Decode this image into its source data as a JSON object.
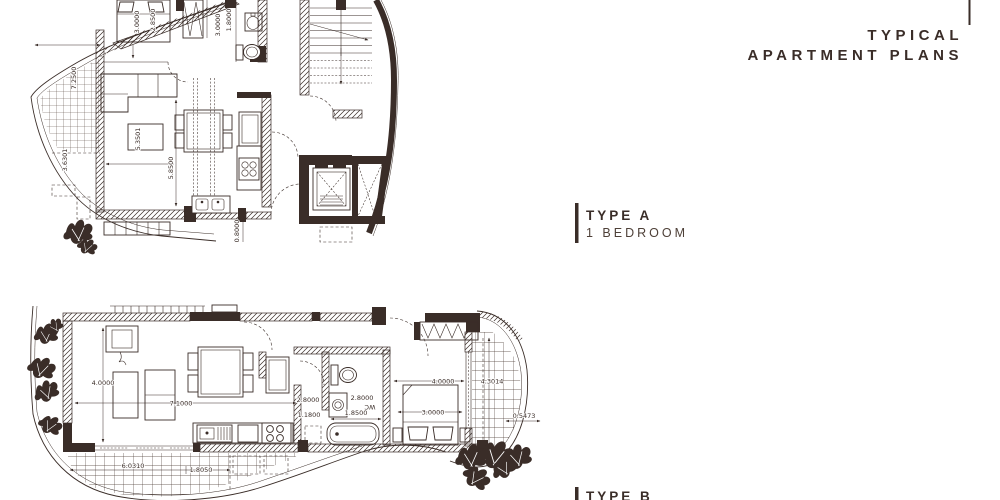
{
  "title": {
    "line1": "TYPICAL",
    "line2": "APARTMENT PLANS"
  },
  "legend_a": {
    "type": "TYPE A",
    "subtitle": "1 BEDROOM"
  },
  "legend_b": {
    "type": "TYPE B"
  },
  "colors": {
    "ink": "#3a2d28",
    "background": "#ffffff"
  },
  "plan_a": {
    "name": "Type A one-bedroom apartment floor plan",
    "dims": {
      "bed_w": "3.0000",
      "bed_l": "2.8500",
      "hall": "3.0000",
      "bath": "1.8000",
      "terrace": "7.2500",
      "terrace2": "3.6301",
      "coffee": "5.3501",
      "living": "5.8500",
      "door": "0.8000"
    }
  },
  "plan_b": {
    "name": "Type B apartment floor plan",
    "rooms": {
      "wc": "WC"
    },
    "dims": {
      "living_h": "4.0000",
      "living_w": "7.1000",
      "kitchen_h": "2.8000",
      "kitchen_w": "1.1800",
      "bath_h": "2.8000",
      "bath_w": "1.8500",
      "bed_w": "3.0000",
      "bedroom": "4.0000",
      "balcony_l": "4.3014",
      "balcony_w": "0.5473",
      "terrace_w": "6.0310",
      "terrace_w2": "1.8050"
    }
  }
}
